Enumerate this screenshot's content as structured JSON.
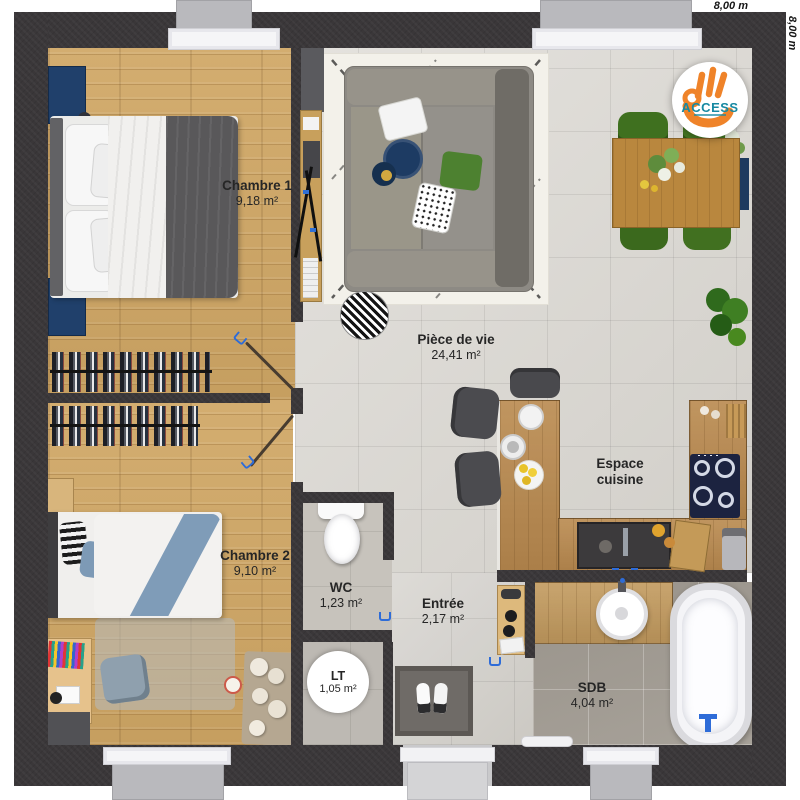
{
  "plan": {
    "type": "floor-plan",
    "dimensions": {
      "width_label": "8,00 m",
      "height_label": "8,00 m"
    },
    "logo": {
      "brand": "ACCESS"
    },
    "rooms": {
      "chambre1": {
        "name": "Chambre 1",
        "area": "9,18 m²"
      },
      "pieceDeVie": {
        "name": "Pièce de vie",
        "area": "24,41 m²"
      },
      "chambre2": {
        "name": "Chambre 2",
        "area": "9,10 m²"
      },
      "wc": {
        "name": "WC",
        "area": "1,23 m²"
      },
      "entree": {
        "name": "Entrée",
        "area": "2,17 m²"
      },
      "lt": {
        "name": "LT",
        "area": "1,05 m²"
      },
      "cuisine": {
        "name": "Espace cuisine",
        "name_line1": "Espace",
        "name_line2": "cuisine"
      },
      "sdb": {
        "name": "SDB",
        "area": "4,04 m²"
      }
    },
    "colors": {
      "wall": "#3a3739",
      "wood_floor": "#d0a765",
      "kitchen_counter": "#b9894e",
      "tile_light": "#dad7d1",
      "tile_bath": "#a29c93",
      "accent_navy": "#1e3a5f",
      "chair_green": "#3f701f",
      "logo_orange": "#ef8329",
      "logo_teal": "#1789a2",
      "door_handle_blue": "#2e6cd8"
    }
  }
}
